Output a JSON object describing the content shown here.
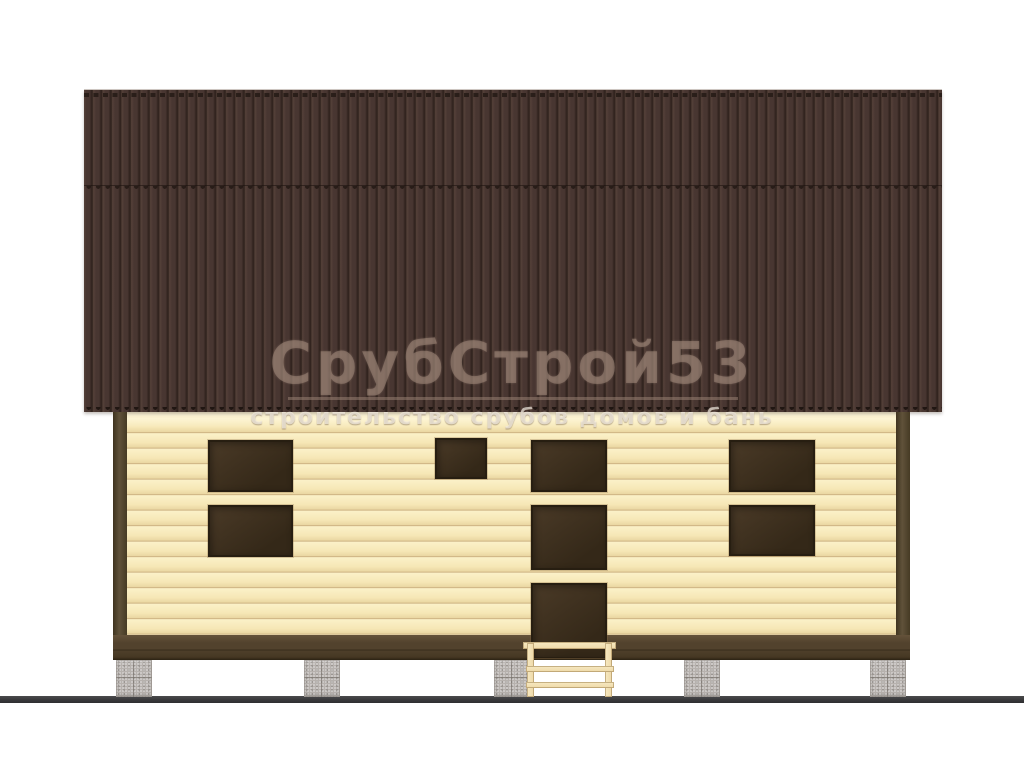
{
  "watermark": {
    "title": "СрубСтрой53",
    "subtitle": "строительство срубов домов и бань"
  },
  "colors": {
    "bg": "#ffffff",
    "roof_base": "#483631",
    "roof_rib": "#554139",
    "roof_groove": "#32241f",
    "roof_dash": "#241a15",
    "roof_edge_light": "#cdc6c1",
    "wall_light": "#fbf1c8",
    "wall_mid": "#f6e7b6",
    "wall_shade": "#ead7a3",
    "wall_line": "#c6a978",
    "wall_top_glow": "#fff8e0",
    "post_dark": "#3f3420",
    "post_mid": "#60523a",
    "post_deep": "#463a24",
    "window_fill": "#4a3a27",
    "window_deep": "#342818",
    "window_frame": "#271e11",
    "plinth_top": "#64523a",
    "plinth_mid": "#52422d",
    "plinth_line": "#372b1b",
    "plinth_bottom": "#2c2214",
    "pier_base": "#b6b1ad",
    "pier_mortar": "#78726c",
    "ground": "#39393b",
    "ground_top": "#4a4a4c",
    "ladder_fill_light": "#f7e9c2",
    "ladder_fill": "#eed9a8",
    "ladder_edge": "#96804f",
    "wm_title": "rgba(158,134,120,0.55)",
    "wm_underline": "rgba(158,134,120,0.5)",
    "wm_subtitle": "rgba(242,236,226,0.72)",
    "wm_subtitle_shadow": "rgba(85,62,45,0.4)"
  },
  "elevation": {
    "openings": [
      {
        "role": "window",
        "x": 208,
        "y": 440,
        "w": 85,
        "h": 52
      },
      {
        "role": "window",
        "x": 208,
        "y": 505,
        "w": 85,
        "h": 52
      },
      {
        "role": "small-window",
        "x": 435,
        "y": 438,
        "w": 52,
        "h": 41
      },
      {
        "role": "window",
        "x": 531,
        "y": 440,
        "w": 76,
        "h": 52
      },
      {
        "role": "window",
        "x": 531,
        "y": 505,
        "w": 76,
        "h": 65
      },
      {
        "role": "door",
        "x": 531,
        "y": 583,
        "w": 76,
        "h": 75
      },
      {
        "role": "window",
        "x": 729,
        "y": 440,
        "w": 86,
        "h": 52
      },
      {
        "role": "window",
        "x": 729,
        "y": 505,
        "w": 86,
        "h": 51
      }
    ],
    "piers": [
      {
        "x": 116
      },
      {
        "x": 304
      },
      {
        "x": 494
      },
      {
        "x": 684
      },
      {
        "x": 870
      }
    ],
    "pier_size": {
      "w": 36,
      "h": 37,
      "y": 660
    }
  }
}
